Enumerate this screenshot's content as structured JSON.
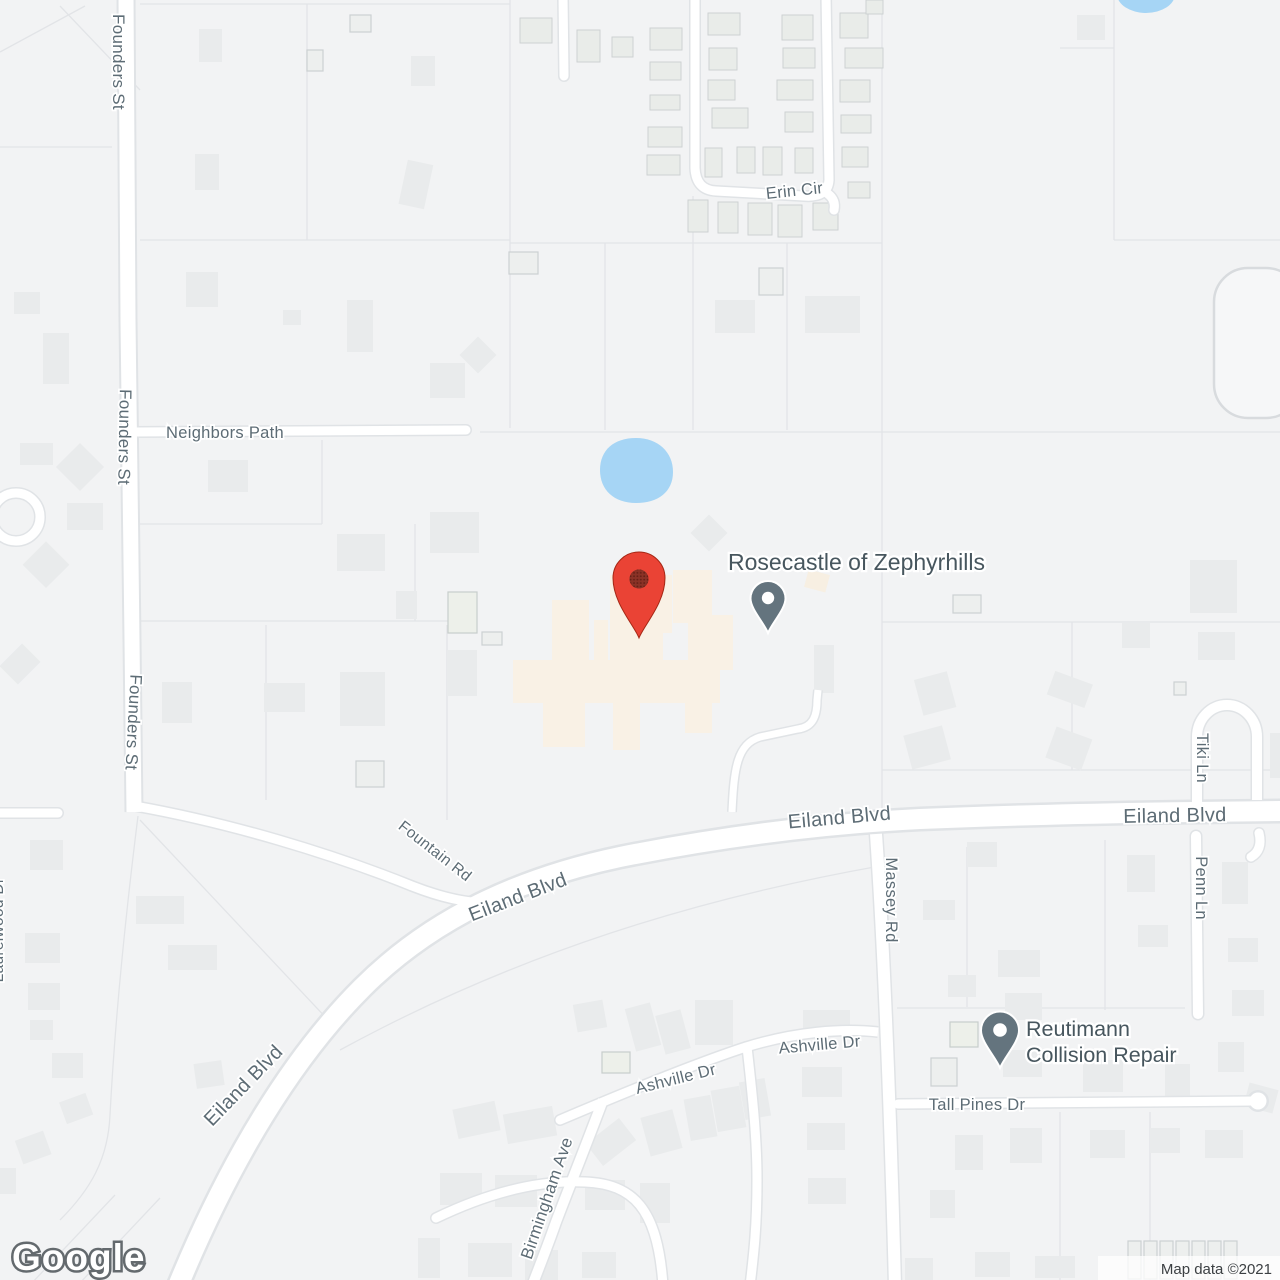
{
  "map": {
    "watermark": "Google",
    "attribution": "Map data ©2021",
    "roads": {
      "founders_st": "Founders St",
      "neighbors_path": "Neighbors Path",
      "erin_cir": "Erin Cir",
      "eiland_blvd": "Eiland Blvd",
      "fountain_rd": "Fountain Rd",
      "massey_rd": "Massey Rd",
      "tiki_ln": "Tiki Ln",
      "penn_ln": "Penn Ln",
      "ashville_dr": "Ashville Dr",
      "tall_pines_dr": "Tall Pines Dr",
      "birmingham_ave": "Birmingham Ave",
      "laurelwood_dr": "Laurelwood Dr"
    },
    "pois": {
      "rosecastle": {
        "label": "Rosecastle of Zephyrhills"
      },
      "reutimann": {
        "line1": "Reutimann",
        "line2": "Collision Repair"
      }
    },
    "markers": {
      "red_marker": {
        "color": "#ea4335"
      },
      "poi_pin": {
        "color": "#64747e"
      }
    },
    "colors": {
      "background": "#f2f3f4",
      "road_fill": "#ffffff",
      "road_casing": "#e0e3e6",
      "parcel_line": "#e2e4e7",
      "building": "#e9ebec",
      "facility_building": "#f9f1e5",
      "water": "#a6d5f5",
      "road_label": "#5d6c75",
      "poi_label": "#47565e",
      "attribution_text": "#3c4043"
    }
  }
}
